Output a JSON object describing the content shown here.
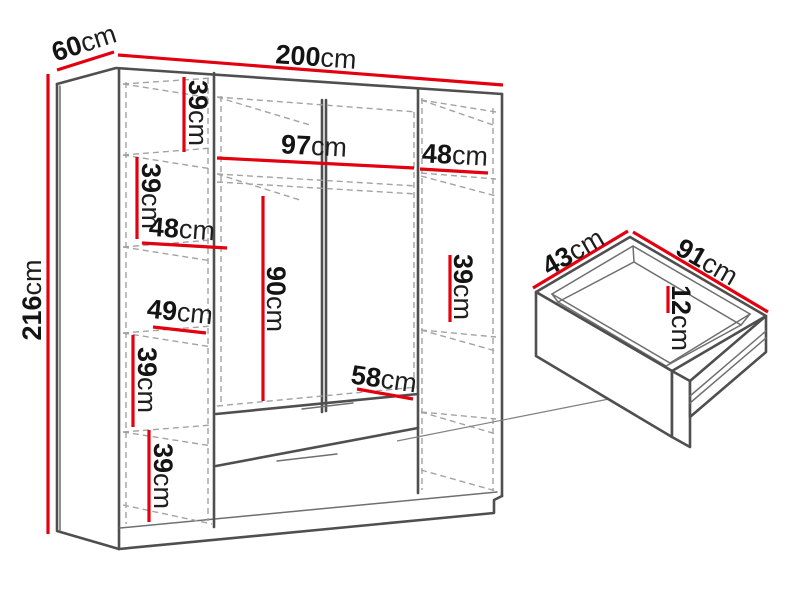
{
  "diagram_title": "Wardrobe with drawer dimensions",
  "wardrobe": {
    "height": {
      "value": "216",
      "unit": "cm"
    },
    "width": {
      "value": "200",
      "unit": "cm"
    },
    "depth": {
      "value": "60",
      "unit": "cm"
    },
    "left_column": {
      "shelf1_height": {
        "value": "39",
        "unit": "cm"
      },
      "shelf2_height": {
        "value": "39",
        "unit": "cm"
      },
      "shelf_width": {
        "value": "48",
        "unit": "cm"
      },
      "shelf3_height": {
        "value": "49",
        "unit": "cm"
      },
      "shelf4_height": {
        "value": "39",
        "unit": "cm"
      },
      "shelf5_height": {
        "value": "39",
        "unit": "cm"
      }
    },
    "middle_section": {
      "width": {
        "value": "97",
        "unit": "cm"
      },
      "hanging_height": {
        "value": "90",
        "unit": "cm"
      },
      "drawer_width": {
        "value": "58",
        "unit": "cm"
      }
    },
    "right_column": {
      "shelf_width": {
        "value": "48",
        "unit": "cm"
      },
      "shelf_height": {
        "value": "39",
        "unit": "cm"
      }
    }
  },
  "drawer": {
    "depth": {
      "value": "43",
      "unit": "cm"
    },
    "width": {
      "value": "91",
      "unit": "cm"
    },
    "height": {
      "value": "12",
      "unit": "cm"
    }
  },
  "colors": {
    "dimension_red": "#e3000f",
    "outline_gray": "#4f4f4f",
    "dashed_gray": "#a3a3a3"
  }
}
